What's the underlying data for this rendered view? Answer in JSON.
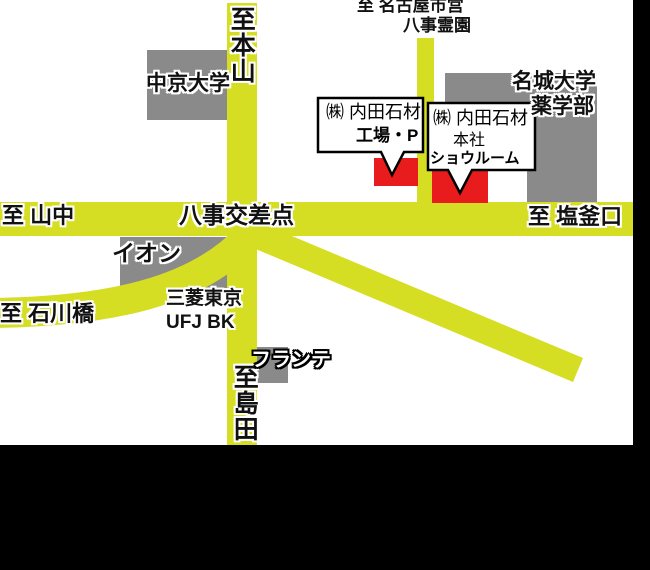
{
  "map_title": "内田石材 アクセスマップ",
  "destinations": {
    "north_east_line1": "至 名古屋市営",
    "north_east_line2": "八事霊園",
    "north": "至本山",
    "west": "至 山中",
    "east": "至 塩釜口",
    "southwest": "至 石川橋",
    "south": "至島田"
  },
  "intersection": {
    "name": "八事交差点"
  },
  "landmarks": {
    "chukyo_university": "中京大学",
    "meijo_university_line1": "名城大学",
    "meijo_university_line2": "薬学部",
    "aeon": "イオン",
    "bank_line1": "三菱東京",
    "bank_line2": "UFJ BK",
    "frante": "フランテ"
  },
  "callouts": {
    "factory": {
      "line1": "㈱ 内田石材",
      "line2": "工場・P"
    },
    "headquarters": {
      "line1": "㈱ 内田石材",
      "line2": "本社",
      "line3": "ショウルーム"
    }
  },
  "colors": {
    "road_yellow": "#d6de23",
    "building_gray": "#8a8a8a",
    "highlight_red": "#e81b1d",
    "background_white": "#ffffff",
    "frame_black": "#000000"
  }
}
